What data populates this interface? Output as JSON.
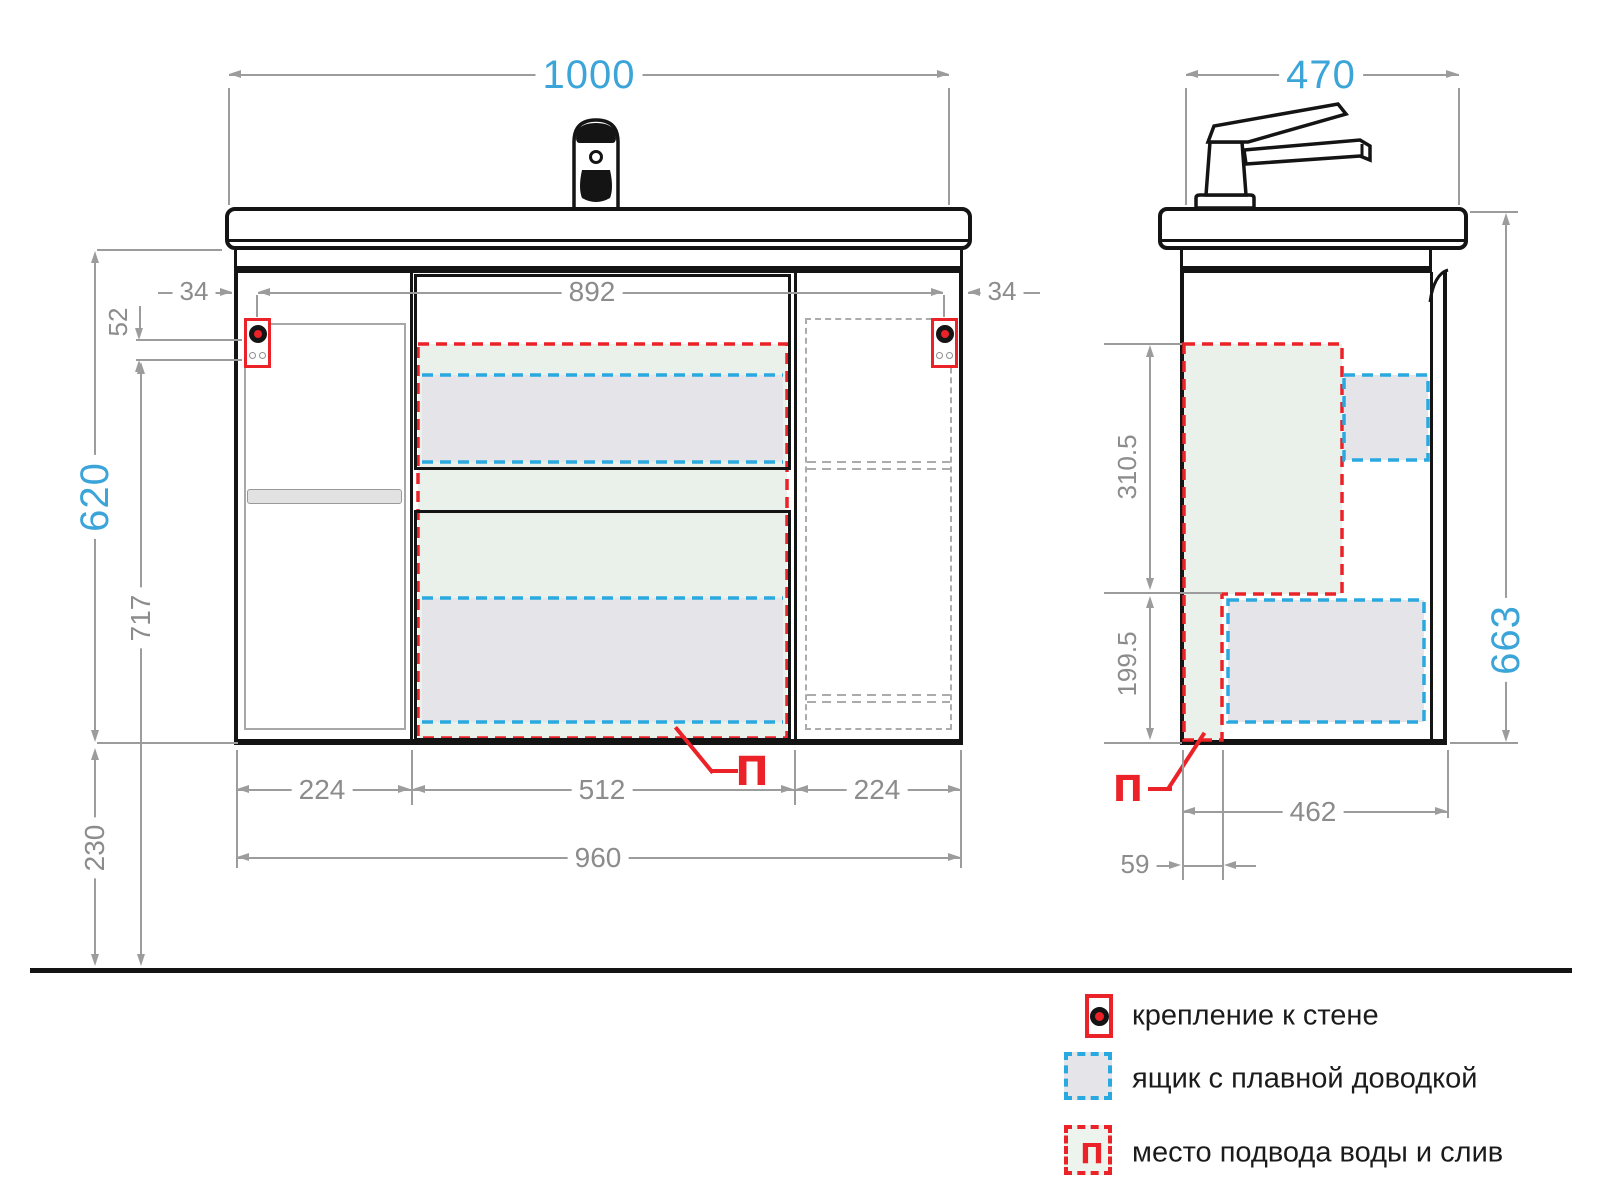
{
  "front": {
    "dims": {
      "total_width": "1000",
      "inner_width": "892",
      "margin_left": "34",
      "margin_right": "34",
      "mount_spacing": "52",
      "body_height": "620",
      "mount_height_from_floor": "717",
      "floor_clearance": "230",
      "bottom_segments": [
        "224",
        "512",
        "224"
      ],
      "bottom_total": "960"
    },
    "supply_label": "П"
  },
  "side": {
    "dims": {
      "total_depth": "470",
      "zone_upper": "310.5",
      "zone_lower": "199.5",
      "total_height": "663",
      "bottom_depth": "462",
      "supply_offset": "59"
    },
    "supply_label": "П"
  },
  "legend": {
    "items": [
      {
        "icon": "wall-mount-icon",
        "label": "крепление к стене"
      },
      {
        "icon": "soft-close-drawer-icon",
        "label": "ящик с плавной доводкой"
      },
      {
        "icon": "water-supply-drain-icon",
        "label": "место подвода воды и слив"
      }
    ]
  },
  "colors": {
    "accent_blue": "#3BA4D8",
    "line_gray": "#9C9C9C",
    "text_gray": "#8C8C8C",
    "red": "#EB2227",
    "drawer_blue": "#2AA9E0",
    "zone_green_fill": "#EAF1EA",
    "drawer_gray_fill": "#E5E5E9",
    "ink": "#141414"
  }
}
